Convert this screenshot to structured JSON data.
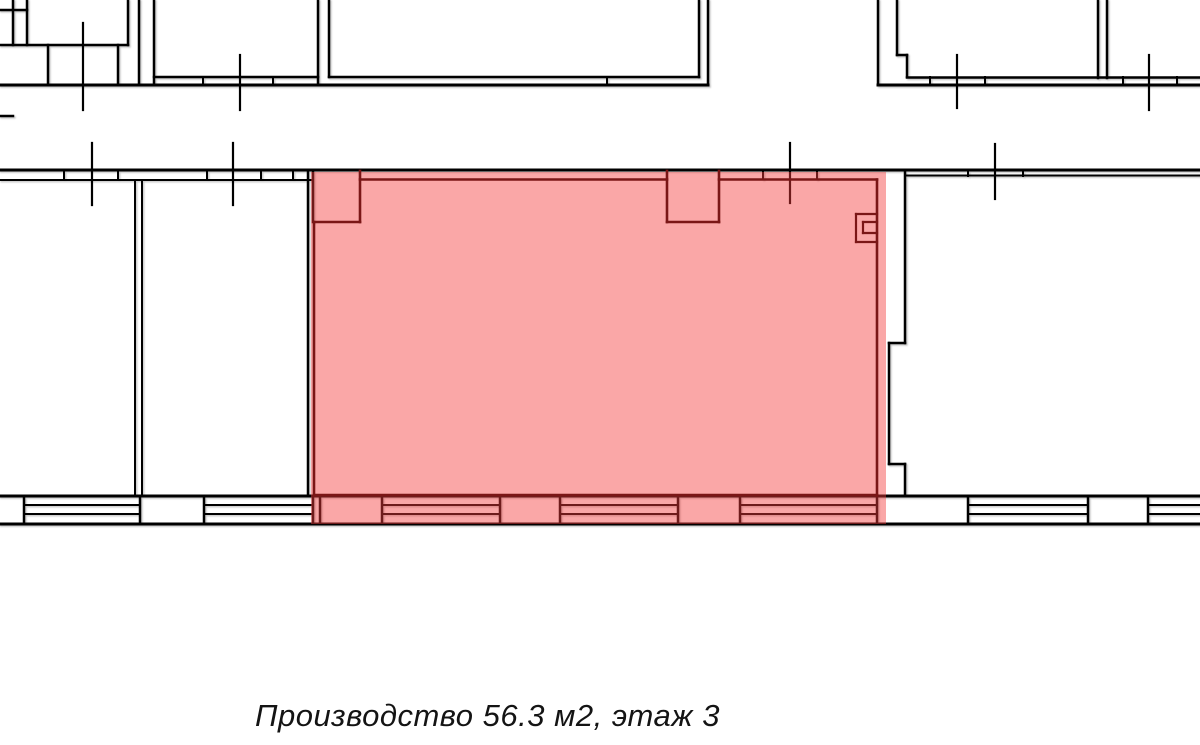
{
  "caption": {
    "text": "Производство 56.3 м2, этаж 3"
  },
  "colors": {
    "background": "#ffffff",
    "wall": "#000000",
    "room_outline": "#7a1616",
    "highlight_fill": "rgba(244,60,60,0.45)",
    "caption_text": "#141414"
  },
  "plan": {
    "canvas": {
      "width": 1200,
      "height": 745
    },
    "highlight": {
      "x": 311,
      "y": 172,
      "width": 575,
      "height": 352
    },
    "layers": [
      {
        "name": "walls-layer",
        "type": "lines",
        "color_key": "wall",
        "shadow": true,
        "segments": [
          [
            0,
            10,
            27,
            10,
            2.5
          ],
          [
            13,
            0,
            13,
            45,
            2.5
          ],
          [
            27,
            0,
            27,
            45,
            2.5
          ],
          [
            0,
            45,
            128,
            45,
            2.5
          ],
          [
            48,
            45,
            48,
            85,
            2.5
          ],
          [
            118,
            45,
            118,
            85,
            2.5
          ],
          [
            128,
            0,
            128,
            45,
            2.5
          ],
          [
            139,
            0,
            139,
            85,
            2.5
          ],
          [
            154,
            0,
            154,
            85,
            2.5
          ],
          [
            0,
            85,
            708,
            85,
            3
          ],
          [
            154,
            77,
            318,
            77,
            2.5
          ],
          [
            203,
            77,
            203,
            85,
            2
          ],
          [
            273,
            77,
            273,
            85,
            2
          ],
          [
            318,
            0,
            318,
            85,
            2.5
          ],
          [
            329,
            0,
            329,
            77,
            2.5
          ],
          [
            329,
            77,
            699,
            77,
            2.5
          ],
          [
            607,
            77,
            607,
            85,
            2
          ],
          [
            699,
            0,
            699,
            77,
            2.5
          ],
          [
            708,
            0,
            708,
            85,
            2.5
          ],
          [
            878,
            0,
            878,
            85,
            2.5
          ],
          [
            897,
            0,
            897,
            55,
            2.5
          ],
          [
            897,
            55,
            907,
            55,
            2.5
          ],
          [
            907,
            55,
            907,
            77,
            2.5
          ],
          [
            878,
            85,
            1200,
            85,
            3
          ],
          [
            907,
            77.5,
            1200,
            77.5,
            2.5
          ],
          [
            930,
            77,
            930,
            85,
            2
          ],
          [
            985,
            77,
            985,
            85,
            2
          ],
          [
            1123,
            77,
            1123,
            85,
            2
          ],
          [
            1177,
            77,
            1177,
            85,
            2
          ],
          [
            1098,
            0,
            1098,
            78,
            2.5
          ],
          [
            1107,
            0,
            1107,
            78,
            2.5
          ],
          [
            0,
            116,
            13,
            116,
            2.5
          ],
          [
            0,
            170,
            1200,
            170,
            3
          ],
          [
            0,
            180,
            311,
            180,
            2
          ],
          [
            64,
            171,
            64,
            180,
            2
          ],
          [
            118,
            171,
            118,
            180,
            2
          ],
          [
            207,
            171,
            207,
            180,
            2
          ],
          [
            261,
            171,
            261,
            180,
            2
          ],
          [
            293,
            171,
            293,
            180,
            2
          ],
          [
            905,
            175.5,
            1200,
            175.5,
            2
          ],
          [
            968,
            171,
            968,
            176,
            2
          ],
          [
            1023,
            171,
            1023,
            176,
            2
          ],
          [
            763,
            171,
            763,
            179,
            2
          ],
          [
            817,
            171,
            817,
            179,
            2
          ],
          [
            313,
            171,
            313,
            222,
            2.5
          ],
          [
            135,
            180,
            135,
            496,
            2
          ],
          [
            142,
            180,
            142,
            496,
            2
          ],
          [
            308,
            171,
            308,
            496,
            2.5
          ],
          [
            905,
            171,
            905,
            343,
            2.5
          ],
          [
            889,
            343,
            905,
            343,
            2.5
          ],
          [
            889,
            343,
            889,
            464,
            2.5
          ],
          [
            889,
            464,
            905,
            464,
            2.5
          ],
          [
            905,
            464,
            905,
            496,
            2.5
          ],
          [
            0,
            496,
            1200,
            496,
            3
          ],
          [
            0,
            524,
            1200,
            524,
            3
          ],
          [
            24,
            505,
            140,
            505,
            2
          ],
          [
            24,
            514,
            140,
            514,
            2
          ],
          [
            204,
            505,
            313,
            505,
            2
          ],
          [
            204,
            514,
            313,
            514,
            2
          ],
          [
            382,
            505,
            500,
            505,
            2
          ],
          [
            382,
            514,
            500,
            514,
            2
          ],
          [
            560,
            505,
            678,
            505,
            2
          ],
          [
            560,
            514,
            678,
            514,
            2
          ],
          [
            740,
            505,
            877,
            505,
            2
          ],
          [
            740,
            514,
            877,
            514,
            2
          ],
          [
            968,
            505,
            1088,
            505,
            2
          ],
          [
            968,
            514,
            1088,
            514,
            2
          ],
          [
            1148,
            505,
            1200,
            505,
            2
          ],
          [
            1148,
            514,
            1200,
            514,
            2
          ],
          [
            24,
            496,
            24,
            524,
            2.5
          ],
          [
            140,
            496,
            140,
            524,
            2.5
          ],
          [
            204,
            496,
            204,
            524,
            2.5
          ],
          [
            313,
            496,
            313,
            524,
            2.5
          ],
          [
            320,
            496,
            320,
            524,
            2.5
          ],
          [
            382,
            496,
            382,
            524,
            2.5
          ],
          [
            500,
            496,
            500,
            524,
            2.5
          ],
          [
            560,
            496,
            560,
            524,
            2.5
          ],
          [
            678,
            496,
            678,
            524,
            2.5
          ],
          [
            740,
            496,
            740,
            524,
            2.5
          ],
          [
            877,
            496,
            877,
            524,
            2.5
          ],
          [
            968,
            496,
            968,
            524,
            2.5
          ],
          [
            1088,
            496,
            1088,
            524,
            2.5
          ],
          [
            1148,
            496,
            1148,
            524,
            2.5
          ]
        ]
      },
      {
        "name": "window-ticks-layer",
        "type": "lines",
        "color_key": "wall",
        "shadow": false,
        "segments": [
          [
            83,
            23,
            83,
            110,
            2.2
          ],
          [
            240,
            55,
            240,
            110,
            2.2
          ],
          [
            957,
            55,
            957,
            108,
            2.2
          ],
          [
            1149,
            55,
            1149,
            110,
            2.2
          ],
          [
            92,
            143,
            92,
            205,
            2.2
          ],
          [
            233,
            143,
            233,
            205,
            2.2
          ],
          [
            790,
            143,
            790,
            203,
            2.2
          ],
          [
            995,
            144,
            995,
            199,
            2.2
          ]
        ]
      },
      {
        "name": "highlight-overlay",
        "type": "rect",
        "color_key": "highlight_fill",
        "interactable": true
      },
      {
        "name": "room-outline",
        "type": "lines",
        "color_key": "room_outline",
        "shadow": false,
        "segments": [
          [
            314,
            222,
            314,
            496,
            2.6
          ],
          [
            314,
            222,
            360,
            222,
            2.6
          ],
          [
            360,
            171,
            360,
            222,
            2.6
          ],
          [
            360,
            179.5,
            667,
            179.5,
            2.6
          ],
          [
            667,
            171,
            667,
            222,
            2.6
          ],
          [
            667,
            222,
            719,
            222,
            2.6
          ],
          [
            719,
            171,
            719,
            222,
            2.6
          ],
          [
            719,
            179.5,
            877,
            179.5,
            2.6
          ],
          [
            877,
            179.5,
            877,
            496,
            2.6
          ],
          [
            314,
            495,
            877,
            495,
            2.6
          ]
        ]
      },
      {
        "name": "shaft-symbol",
        "type": "lines",
        "color_key": "room_outline",
        "shadow": false,
        "segments": [
          [
            856,
            214,
            856,
            242,
            2.2
          ],
          [
            856,
            214,
            877,
            214,
            2.2
          ],
          [
            856,
            242,
            877,
            242,
            2.2
          ],
          [
            863,
            222,
            863,
            233,
            2.2
          ],
          [
            863,
            222,
            877,
            222,
            2.2
          ],
          [
            863,
            233,
            877,
            233,
            2.2
          ]
        ]
      }
    ]
  }
}
